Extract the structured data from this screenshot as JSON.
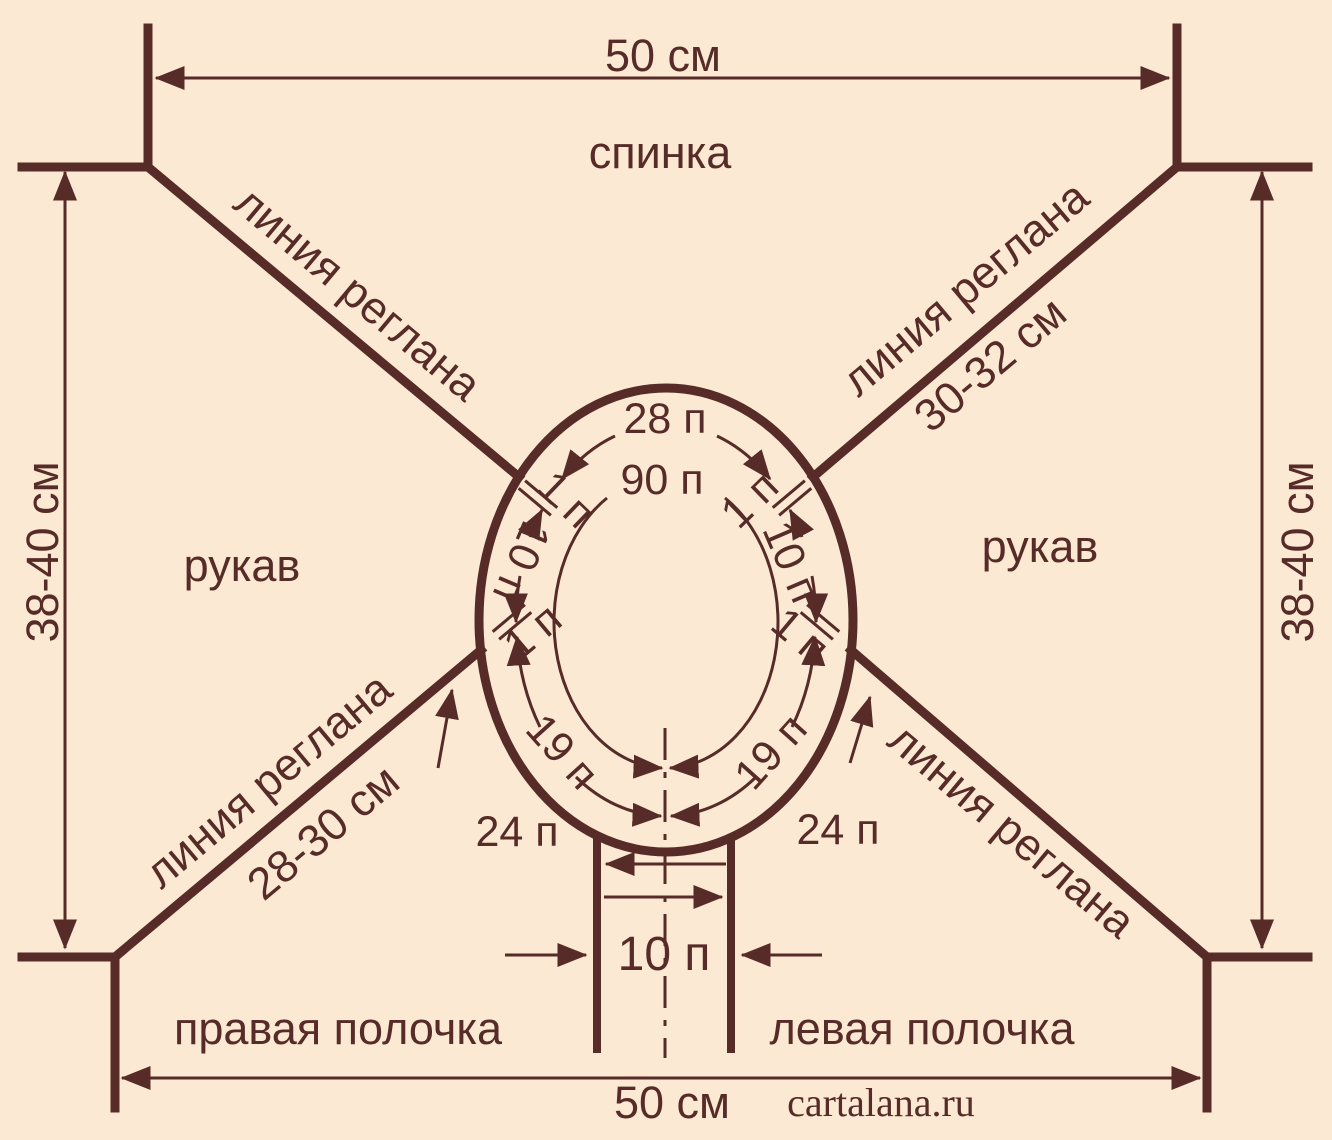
{
  "colors": {
    "background": "#fbe9d3",
    "ink": "#572b27"
  },
  "labels": {
    "back": "спинка",
    "sleeve": "рукав",
    "right_front": "правая полочка",
    "left_front": "левая полочка",
    "raglan_line": "линия реглана",
    "watermark": "cartalana.ru"
  },
  "dimensions": {
    "top_width": "50 см",
    "bottom_width": "50 см",
    "side_height": "38-40 см",
    "raglan_top_right": "30-32 см",
    "raglan_bottom_left": "28-30 см"
  },
  "stitch_counts": {
    "neck_total": "90 п",
    "back_neck": "28 п",
    "sleeve_top": "10 п",
    "raglan_stitch": "1 п",
    "front_neck_half": "19 п",
    "front_shoulder": "24 п",
    "front_center_cut": "10 п"
  }
}
